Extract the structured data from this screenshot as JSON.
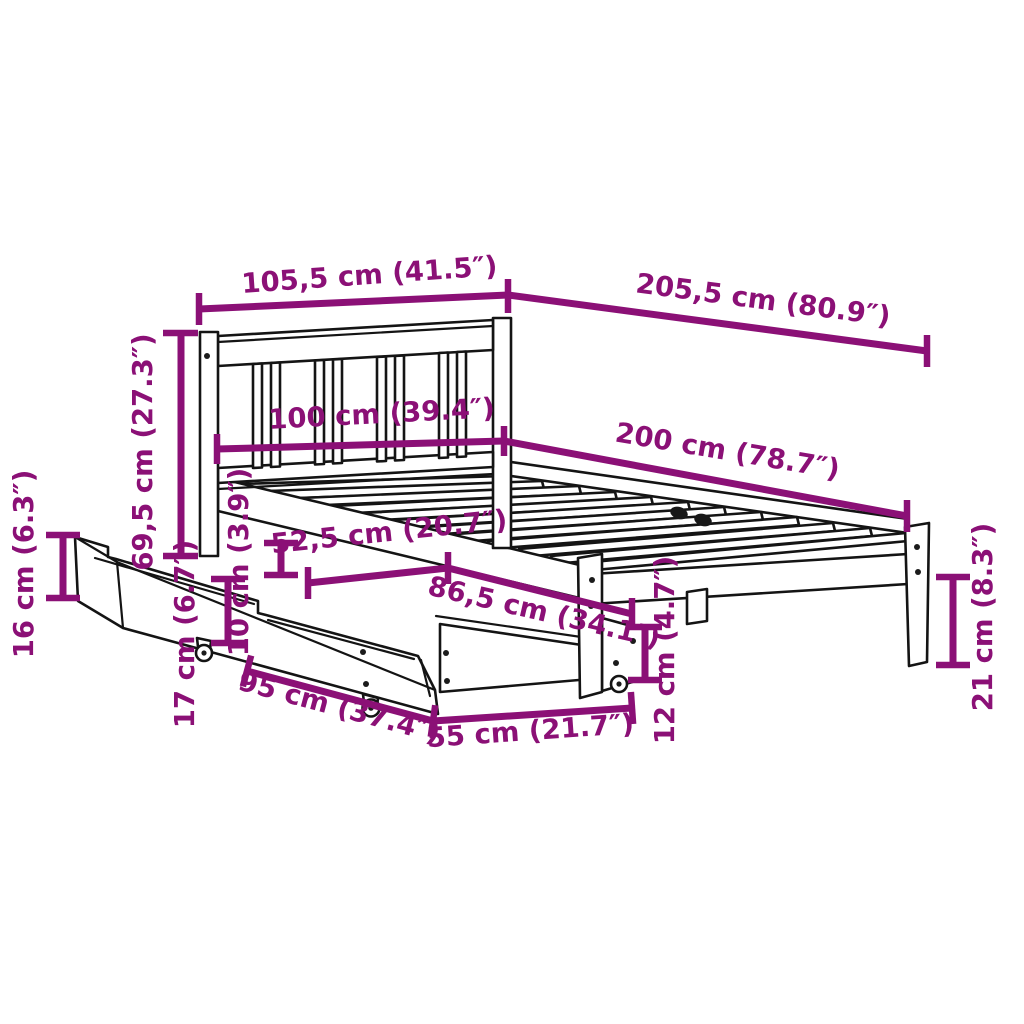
{
  "diagram": {
    "subject": "bed frame with slatted headboard and two under-bed storage drawers on casters",
    "units": "centimetres with inch equivalents"
  },
  "colors": {
    "dimension": "#8B1076",
    "outline": "#141414",
    "background": "#FFFFFF"
  },
  "dimensions": {
    "headboard_width": "105,5 cm (41.5″)",
    "total_length": "205,5 cm (80.9″)",
    "mattress_width": "100 cm (39.4″)",
    "mattress_length": "200 cm (78.7″)",
    "headboard_height": "69,5 cm (27.3″)",
    "drawer_front_height": "16 cm (6.3″)",
    "frame_clearance": "10 cm (3.9″)",
    "drawer_offset": "52,5 cm (20.7″)",
    "drawer_pullout": "86,5 cm (34.1″)",
    "drawer_side_height": "17 cm (6.7″)",
    "drawer_length": "95 cm (37.4″)",
    "drawer_width": "55 cm (21.7″)",
    "rear_drawer_height": "12 cm (4.7″)",
    "leg_height": "21 cm (8.3″)"
  }
}
